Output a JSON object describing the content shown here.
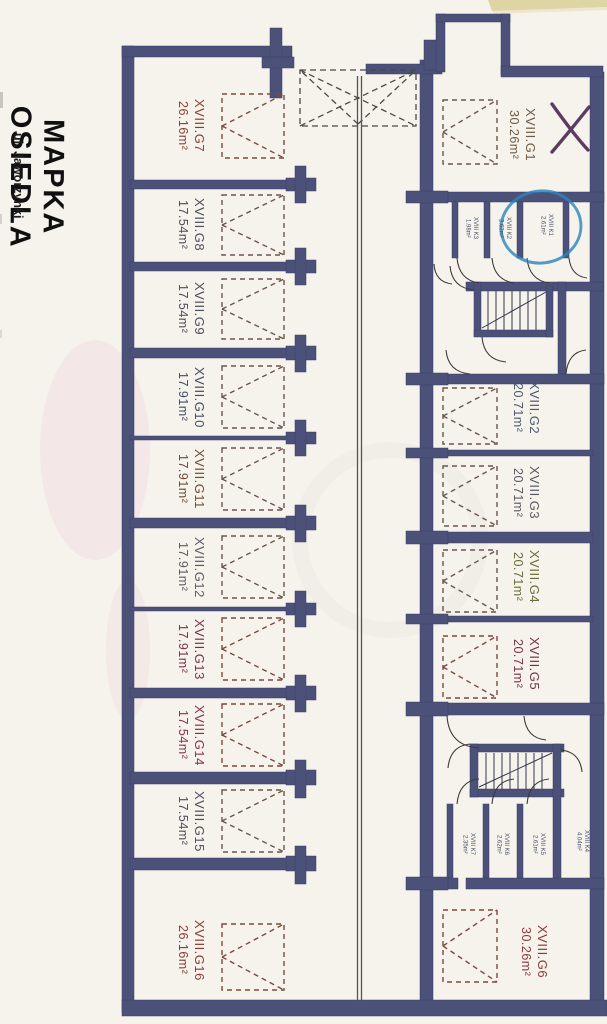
{
  "page": {
    "title": "MAPKA OSIEDLA",
    "subtitle": "ul. Jaworzynki"
  },
  "units": {
    "g1": {
      "id": "XVIII.G1",
      "area": "30.26m²",
      "color": "#6f5a45"
    },
    "g2": {
      "id": "XVIII.G2",
      "area": "20.71m²",
      "color": "#4e586e"
    },
    "g3": {
      "id": "XVIII.G3",
      "area": "20.71m²",
      "color": "#585a63"
    },
    "g4": {
      "id": "XVIII.G4",
      "area": "20.71m²",
      "color": "#6e6c38"
    },
    "g5": {
      "id": "XVIII.G5",
      "area": "20.71m²",
      "color": "#7c3340"
    },
    "g6": {
      "id": "XVIII.G6",
      "area": "30.26m²",
      "color": "#8c3a38"
    },
    "g7": {
      "id": "XVIII.G7",
      "area": "26.16m²",
      "color": "#8a4034"
    },
    "g8": {
      "id": "XVIII.G8",
      "area": "17.54m²",
      "color": "#4d4f5c"
    },
    "g9": {
      "id": "XVIII.G9",
      "area": "17.54m²",
      "color": "#4d4f5c"
    },
    "g10": {
      "id": "XVIII.G10",
      "area": "17.91m²",
      "color": "#454c63"
    },
    "g11": {
      "id": "XVIII.G11",
      "area": "17.91m²",
      "color": "#6d4c3c"
    },
    "g12": {
      "id": "XVIII.G12",
      "area": "17.91m²",
      "color": "#5d5a64"
    },
    "g13": {
      "id": "XVIII.G13",
      "area": "17.91m²",
      "color": "#7c3340"
    },
    "g14": {
      "id": "XVIII.G14",
      "area": "17.54m²",
      "color": "#8a3545"
    },
    "g15": {
      "id": "XVIII.G15",
      "area": "17.54m²",
      "color": "#4d4f5c"
    },
    "g16": {
      "id": "XVIII.G16",
      "area": "26.16m²",
      "color": "#8a3a34"
    }
  },
  "storage": {
    "k1": {
      "id": "XVIII K1",
      "area": "2.61m²"
    },
    "k2": {
      "id": "XVIII K2",
      "area": "2.62m²"
    },
    "k3": {
      "id": "XVIII K3",
      "area": "1.98m²"
    },
    "k4": {
      "id": "XVIII K4",
      "area": "4.04m²"
    },
    "k5": {
      "id": "XVIII K5",
      "area": "2.61m²"
    },
    "k6": {
      "id": "XVIII K6",
      "area": "2.62m²"
    },
    "k7": {
      "id": "XVIII K7",
      "area": "2.35m²"
    }
  },
  "colors": {
    "wall": "#4b5178",
    "paper": "#f6f3ec",
    "corridor_line": "#555555",
    "hand_circle": "#2a85bb",
    "hand_x": "#4d2752"
  }
}
